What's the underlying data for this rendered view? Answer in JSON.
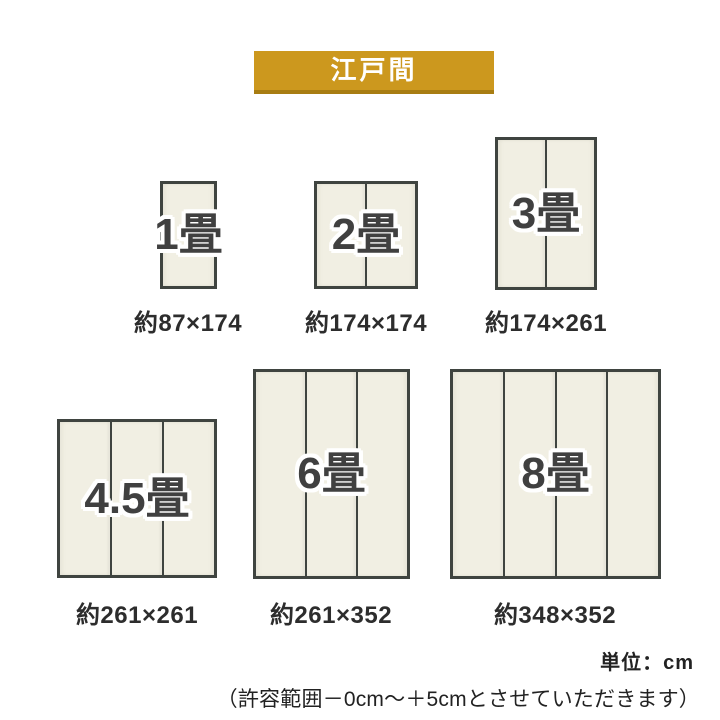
{
  "banner": {
    "title": "江戸間"
  },
  "rooms": [
    {
      "id": "1jo",
      "label": "1畳",
      "size": "約87×174",
      "panels": 1
    },
    {
      "id": "2jo",
      "label": "2畳",
      "size": "約174×174",
      "panels": 2
    },
    {
      "id": "3jo",
      "label": "3畳",
      "size": "約174×261",
      "panels": 2
    },
    {
      "id": "4-5jo",
      "label": "4.5畳",
      "size": "約261×261",
      "panels": 3
    },
    {
      "id": "6jo",
      "label": "6畳",
      "size": "約261×352",
      "panels": 3
    },
    {
      "id": "8jo",
      "label": "8畳",
      "size": "約348×352",
      "panels": 4
    }
  ],
  "footer": {
    "unit": "単位：cm",
    "note": "（許容範囲－0cm～＋5cmとさせていただきます）"
  },
  "colors": {
    "banner_bg": "#CC981E",
    "banner_shadow": "#A87D12",
    "mat_fill": "#F1EFE3",
    "mat_border": "#3F4440",
    "label_text": "#404040",
    "dim_text": "#2D2D2D"
  }
}
